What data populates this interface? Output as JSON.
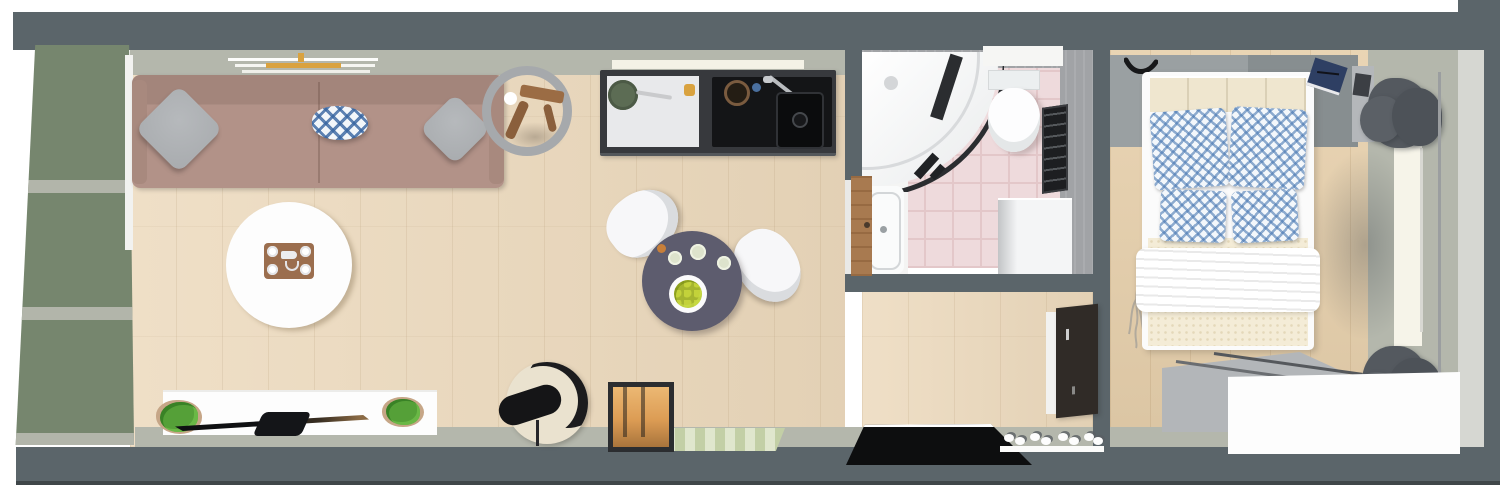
{
  "app": {
    "type": "3d-floor-plan",
    "view": "top-down-render",
    "text_visible": false
  },
  "colors": {
    "outside": "#ffffff",
    "wall": "#5b656a",
    "floor": "#ecd9bc",
    "floor-bedroom": "#e7d0ac",
    "floor-edge": "#b4b7ac",
    "bath-floor": "#eedadc",
    "bath-grout": "#e3c7c9",
    "bath-wall": "#a1a3a6",
    "wardrobe-green": "#76866e",
    "wardrobe-frame": "#b2b5aa",
    "sofa": "#b29288",
    "sofa-dark": "#a3857b",
    "pillow-gray": "#a8abae",
    "pillow-blue": "#3d6ca5",
    "table-white": "#fdfdfd",
    "tray-brown": "#9b6e4e",
    "counter": "#37393d",
    "counter-white": "#e8e9eb",
    "pan-green": "#5c6c54",
    "sink-black": "#141517",
    "dining-table": "#5d5c6e",
    "chair-white": "#f7f7f9",
    "fruit-green": "#a5b52f",
    "lamp-cream": "#eae2cf",
    "lamp-black": "#1c1c1e",
    "lantern-glow": "#dc9c54",
    "rug-green": "#c3cfa6",
    "mat-black": "#0d0e0f",
    "cabinet-dark": "#302b27",
    "fixture-white": "#f7f8f9",
    "glass-dark": "#2b2d30",
    "door-brown": "#a87a50",
    "bed-cream": "#efe6cf",
    "duvet-cream": "#f4ecd7",
    "curtain": "#54595f",
    "dresser-top": "#b3b6b9",
    "plant-green": "#55a038",
    "pot-tan": "#c6a687",
    "gold": "#d9a23f",
    "navy": "#2e3f63",
    "tv-black": "#17181b"
  },
  "scene": {
    "description": "Top-down 3D rendering of a long narrow studio apartment: living room, open kitchen, dining corner, hallway, bathroom and bedroom",
    "rooms": [
      {
        "name": "living-room",
        "furniture": [
          "wardrobe",
          "sofa",
          "throw-pillows",
          "wall-shelf",
          "round-mirror",
          "side-table",
          "coffee-table",
          "serving-tray",
          "tv-sideboard",
          "tv",
          "potted-plants"
        ]
      },
      {
        "name": "kitchen",
        "furniture": [
          "wall-shelf",
          "counter",
          "worktop",
          "frying-pan",
          "cooktop",
          "pot",
          "faucet",
          "sink"
        ]
      },
      {
        "name": "dining-area",
        "furniture": [
          "round-dining-table",
          "fruit-bowl",
          "plates",
          "dining-chairs"
        ]
      },
      {
        "name": "hallway",
        "furniture": [
          "floor-lamp-chair",
          "candle-lantern",
          "striped-rug",
          "entry-mat",
          "shoe-rack",
          "tall-cabinet"
        ]
      },
      {
        "name": "bathroom",
        "furniture": [
          "corner-shower",
          "toilet",
          "wall-shelf",
          "wall-mirror",
          "washing-machine",
          "bathtub",
          "wooden-door"
        ]
      },
      {
        "name": "bedroom",
        "furniture": [
          "double-bed",
          "patterned-pillows",
          "duvet",
          "blanket",
          "wall-hook",
          "notebook",
          "nightstand",
          "curtains",
          "window",
          "curtain-rod",
          "dresser",
          "branch-decor"
        ]
      }
    ],
    "labels": {
      "wardrobe": "Wardrobe with green doors",
      "sofa": "Three-seat sofa",
      "coffee-table": "Round coffee table",
      "tray": "Serving tray with cups",
      "tv-stand": "TV sideboard",
      "tv": "Flat-screen TV",
      "plant": "Potted plant",
      "mirror": "Round mirror",
      "side-table": "Wooden side table",
      "shelf": "Wall shelf",
      "counter": "Kitchen counter",
      "pan": "Frying pan",
      "sink": "Kitchen sink",
      "dining-table": "Round dining table",
      "chair": "Dining chair",
      "fruit-bowl": "Fruit bowl",
      "floor-lamp": "Round lounge chair with lamp",
      "lantern": "Candle lantern",
      "rug": "Striped runner rug",
      "entry-mat": "Black entry mat",
      "shoe-rack": "Shoe rack with shoes",
      "cabinet": "Tall dark cabinet",
      "shower": "Corner shower",
      "toilet": "Toilet",
      "bathtub": "Bathtub",
      "washer": "Washing machine",
      "door": "Wooden bathroom door",
      "bath-mirror": "Bathroom mirror",
      "bed": "Double bed",
      "pillow": "Patterned pillow",
      "curtain": "Curtain",
      "window": "Window",
      "dresser": "Bedroom dresser",
      "notebook": "Notebook",
      "hook": "Wall hook",
      "nightstand": "Nightstand"
    }
  }
}
